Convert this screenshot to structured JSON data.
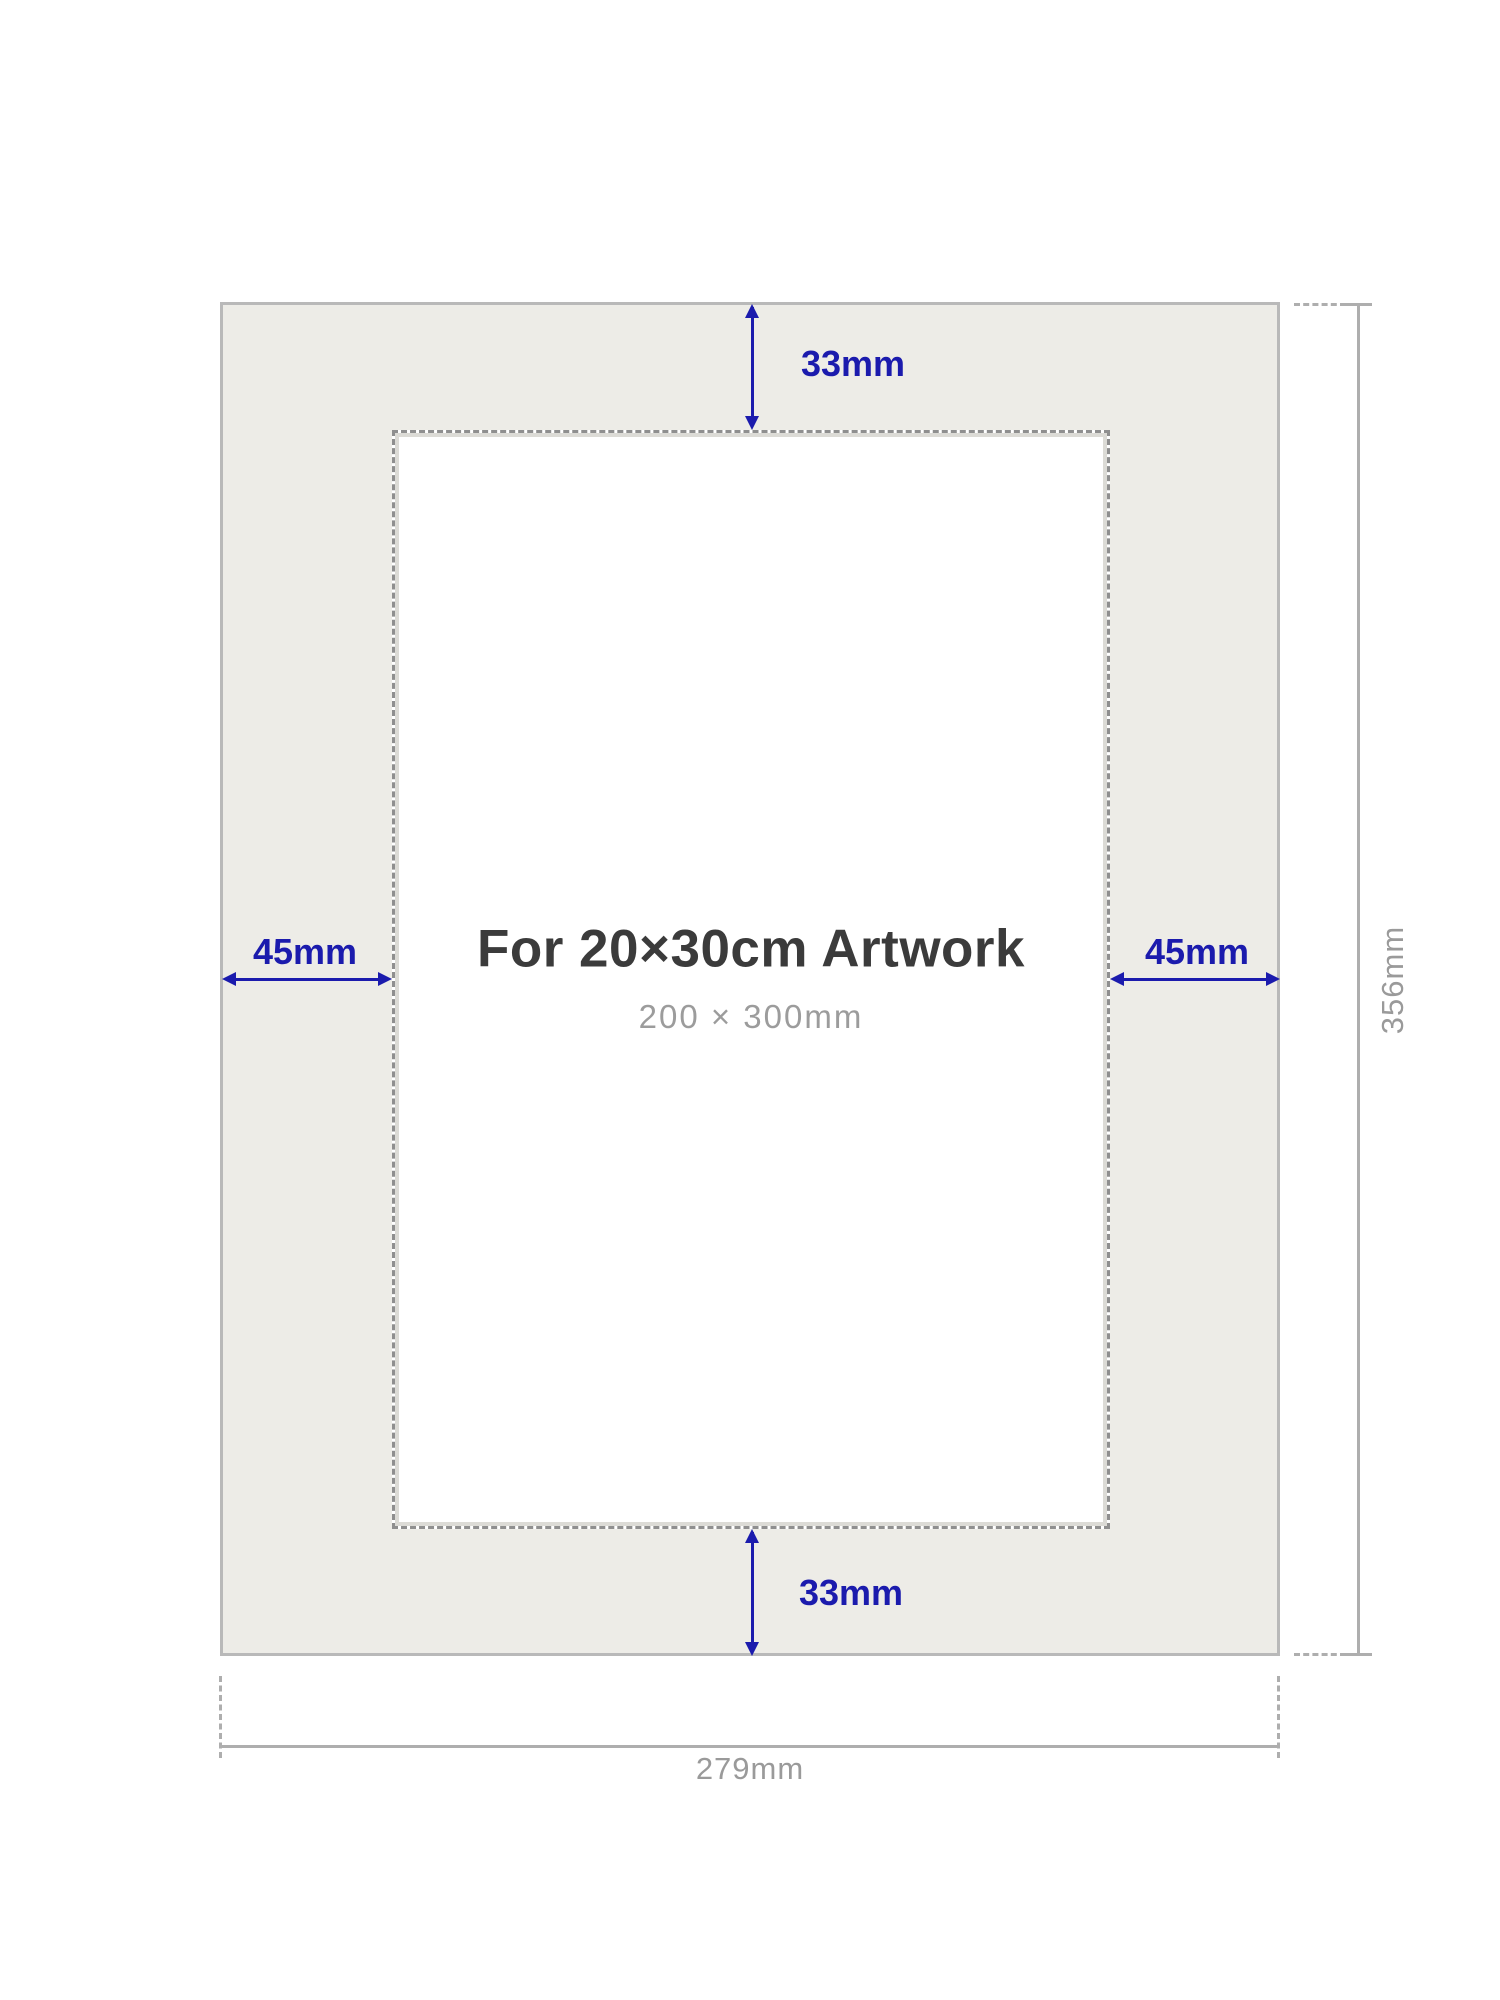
{
  "diagram": {
    "title": "For 20×30cm Artwork",
    "subtitle": "200 × 300mm",
    "dimensions": {
      "top_border": "33mm",
      "bottom_border": "33mm",
      "left_border": "45mm",
      "right_border": "45mm",
      "outer_height": "356mm",
      "outer_width": "279mm"
    },
    "colors": {
      "accent_blue": "#1b1bad",
      "dimension_gray": "#9a9a9a",
      "title_dark": "#3b3b3b",
      "mat_fill": "#edece7",
      "mat_border": "#b9b9b9",
      "window_dash": "#8f8f8f"
    }
  }
}
